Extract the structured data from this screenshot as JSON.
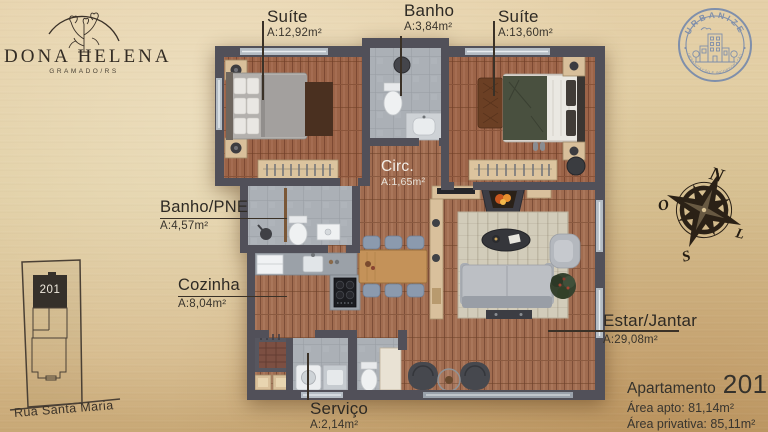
{
  "branding": {
    "name": "DONA HELENA",
    "location": "GRAMADO/RS"
  },
  "stamp": {
    "name": "URBANIZE",
    "tagline": "URBANIZAÇÃO E INCORPORAÇÃO"
  },
  "compass": {
    "n": "N",
    "s": "S",
    "o": "O",
    "l": "L"
  },
  "rooms": {
    "suite1": {
      "name": "Suíte",
      "area": "A:12,92m²"
    },
    "banho": {
      "name": "Banho",
      "area": "A:3,84m²"
    },
    "suite2": {
      "name": "Suíte",
      "area": "A:13,60m²"
    },
    "circ": {
      "name": "Circ.",
      "area": "A:1,65m²"
    },
    "banho_pne": {
      "name": "Banho/PNE",
      "area": "A:4,57m²"
    },
    "cozinha": {
      "name": "Cozinha",
      "area": "A:8,04m²"
    },
    "estar": {
      "name": "Estar/Jantar",
      "area": "A:29,08m²"
    },
    "servico": {
      "name": "Serviço",
      "area": "A:2,14m²"
    }
  },
  "site_plan": {
    "unit": "201",
    "street": "Rua Santa Maria"
  },
  "apartment": {
    "label": "Apartamento",
    "number": "201",
    "area_total": "Área apto: 81,14m²",
    "area_private": "Área privativa: 85,11m²"
  },
  "colors": {
    "paper": "#ddc79c",
    "wall": "#515059",
    "wood": "#a06c50",
    "tile": "#abb0b6",
    "ink": "#332c24",
    "stamp_blue": "#7589ac"
  }
}
